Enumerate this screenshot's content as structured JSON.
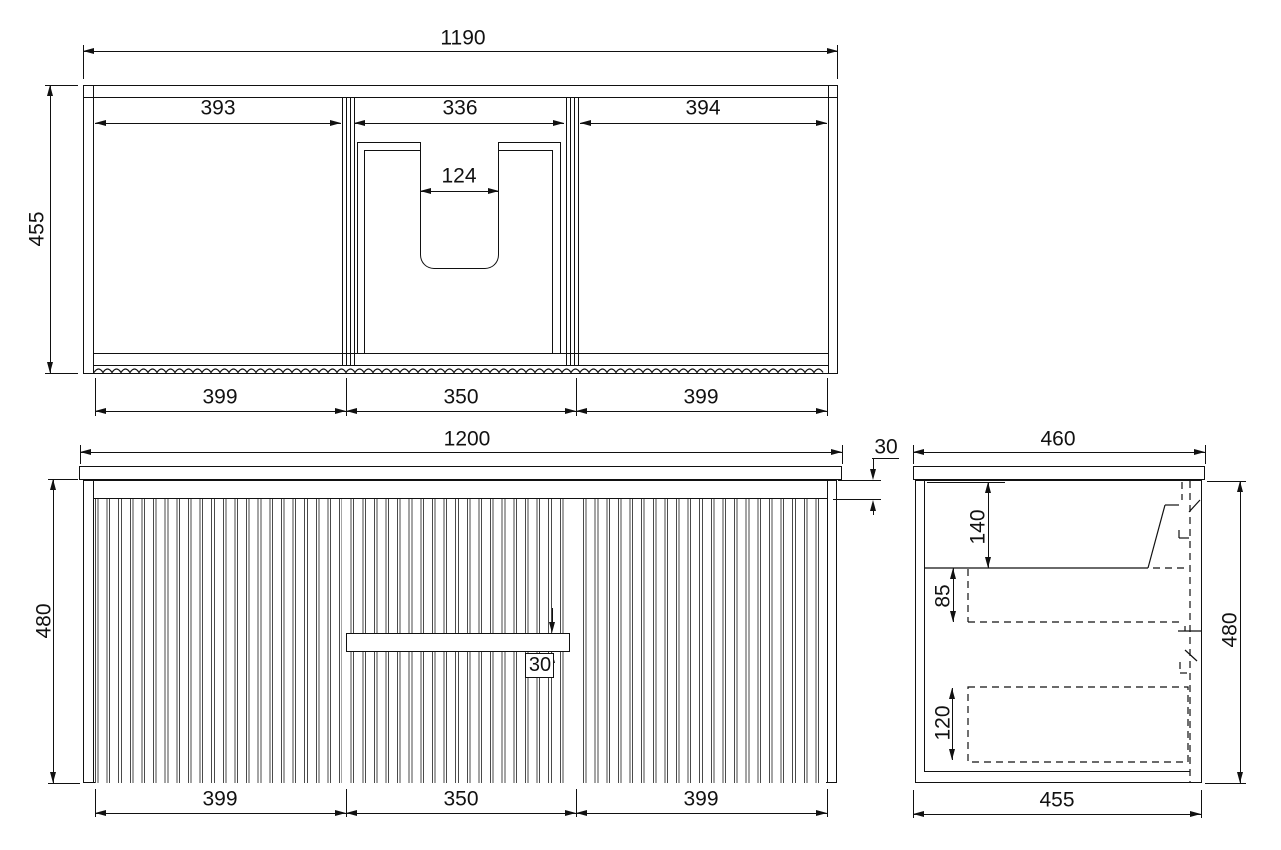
{
  "drawing": {
    "plan": {
      "overall_width": "1190",
      "overall_depth": "455",
      "opening_left": "393",
      "opening_center": "336",
      "opening_right": "394",
      "cutout_width": "124",
      "front_left": "399",
      "front_center": "350",
      "front_right": "399"
    },
    "front": {
      "overall_width": "1200",
      "overall_height": "480",
      "top_reveal": "30",
      "handle_gap": "30",
      "door_left": "399",
      "drawer_center": "350",
      "door_right": "399"
    },
    "side": {
      "overall_depth": "460",
      "overall_height": "480",
      "basin_drop": "140",
      "drawer_offset": "85",
      "lower_drawer": "120",
      "carcass_depth": "455"
    }
  }
}
